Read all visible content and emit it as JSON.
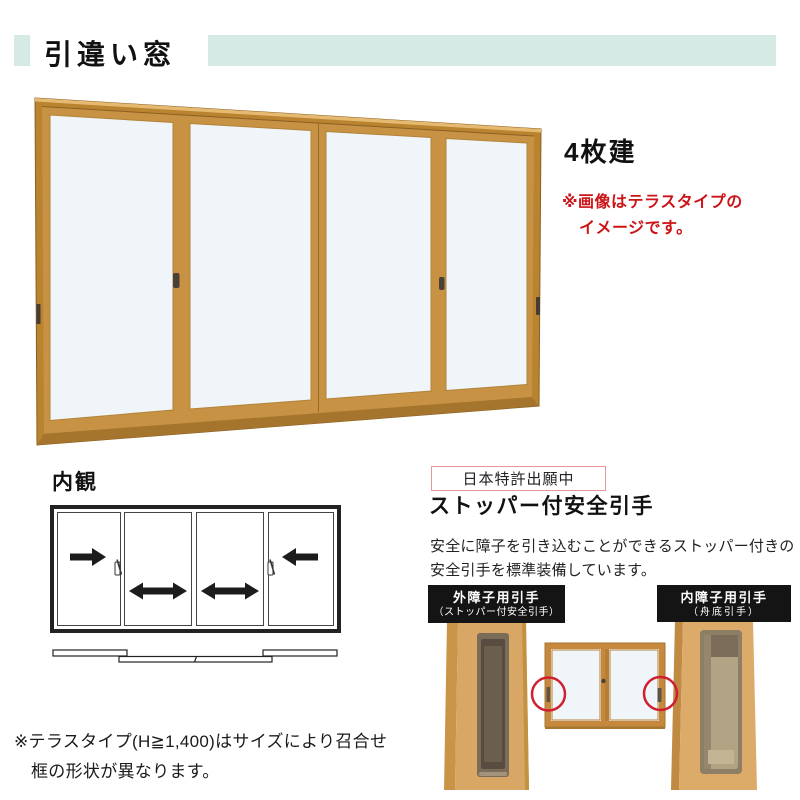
{
  "header": {
    "title": "引違い窓"
  },
  "hero": {
    "panel_count_label": "4枚建",
    "note_line1": "※画像はテラスタイプの",
    "note_line2": "イメージです。"
  },
  "interior": {
    "label": "内観"
  },
  "feature": {
    "patent_badge": "日本特許出願中",
    "title": "ストッパー付安全引手",
    "desc_line1": "安全に障子を引き込むことができるストッパー付きの",
    "desc_line2": "安全引手を標準装備しています。",
    "outer_handle_label_line1": "外障子用引手",
    "outer_handle_label_line2": "（ストッパー付安全引手）",
    "inner_handle_label_line1": "内障子用引手",
    "inner_handle_label_line2": "（舟底引手）"
  },
  "footnote": {
    "line1": "※テラスタイプ(H≧1,400)はサイズにより召合せ",
    "line2": "框の形状が異なります。"
  },
  "icons": {
    "slide_right_arrow": "right-arrow",
    "slide_left_arrow": "left-arrow",
    "slide_both_arrow": "double-headed-arrow",
    "crescent_lock": "crescent-lock",
    "handle_highlight": "red-circle"
  },
  "colors": {
    "accent": "#d5eae4",
    "note_red": "#cc1417",
    "patent_border": "#e5999b",
    "label_bg": "#141414",
    "frame_gold": "#c89245",
    "glass": "#eff5f8",
    "circle_red": "#d01f30"
  }
}
